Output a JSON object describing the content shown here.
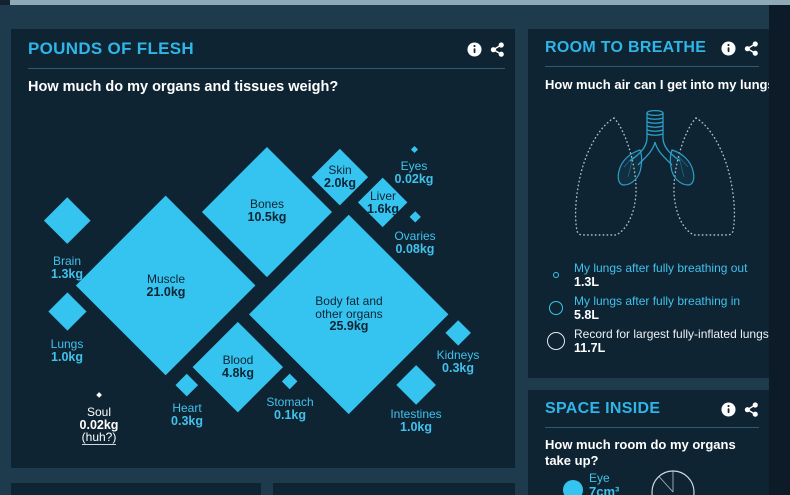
{
  "page": {
    "top_strip_color": "#90a9b9",
    "background_color": "#1d3b4c",
    "panel_color": "#0e2433",
    "accent_color": "#35c4f0"
  },
  "pounds_panel": {
    "title": "POUNDS OF FLESH",
    "question": "How much do my organs and tissues weigh?"
  },
  "breathe_panel": {
    "title": "ROOM TO BREATHE",
    "question": "How much air can I get into my lungs?",
    "legend": [
      {
        "label": "My lungs after fully breathing out",
        "value": "1.3L"
      },
      {
        "label": "My lungs after fully breathing in",
        "value": "5.8L"
      },
      {
        "label": "Record for largest fully-inflated lungs",
        "value": "11.7L"
      }
    ]
  },
  "space_panel": {
    "title": "SPACE INSIDE",
    "question": "How much room do my organs take up?",
    "items": [
      {
        "name": "Eye",
        "value": "7cm³"
      }
    ]
  },
  "chart_data": [
    {
      "type": "diamond-area",
      "title": "POUNDS OF FLESH",
      "question": "How much do my organs and tissues weigh?",
      "unit": "kg",
      "points": [
        {
          "name_lines": [
            "Muscle"
          ],
          "weight": "21.0kg",
          "value_kg": 21.0,
          "cx": 155,
          "cy": 257,
          "r": 90,
          "label": "inside",
          "label_top": 244
        },
        {
          "name_lines": [
            "Bones"
          ],
          "weight": "10.5kg",
          "value_kg": 10.5,
          "cx": 256,
          "cy": 183,
          "r": 65,
          "label": "inside",
          "label_top": 169
        },
        {
          "name_lines": [
            "Body fat and",
            "other organs"
          ],
          "weight": "25.9kg",
          "value_kg": 25.9,
          "cx": 338,
          "cy": 286,
          "r": 100,
          "label": "inside",
          "label_top": 266
        },
        {
          "name_lines": [
            "Blood"
          ],
          "weight": "4.8kg",
          "value_kg": 4.8,
          "cx": 227,
          "cy": 338,
          "r": 45,
          "label": "inside",
          "label_top": 325
        },
        {
          "name_lines": [
            "Skin"
          ],
          "weight": "2.0kg",
          "value_kg": 2.0,
          "cx": 329,
          "cy": 148,
          "r": 28,
          "label": "inside",
          "label_top": 135
        },
        {
          "name_lines": [
            "Liver"
          ],
          "weight": "1.6kg",
          "value_kg": 1.6,
          "cx": 372,
          "cy": 174,
          "r": 25,
          "label": "inside",
          "label_top": 161
        },
        {
          "name_lines": [
            "Brain"
          ],
          "weight": "1.3kg",
          "value_kg": 1.3,
          "cx": 56,
          "cy": 191,
          "r": 23,
          "label": "outside",
          "label_top": 226
        },
        {
          "name_lines": [
            "Lungs"
          ],
          "weight": "1.0kg",
          "value_kg": 1.0,
          "cx": 56,
          "cy": 282,
          "r": 19,
          "label": "outside",
          "label_top": 309
        },
        {
          "name_lines": [
            "Heart"
          ],
          "weight": "0.3kg",
          "value_kg": 0.3,
          "cx": 176,
          "cy": 356,
          "r": 11,
          "label": "outside",
          "label_top": 373
        },
        {
          "name_lines": [
            "Stomach"
          ],
          "weight": "0.1kg",
          "value_kg": 0.1,
          "cx": 279,
          "cy": 353,
          "r": 8,
          "label": "outside",
          "label_top": 367
        },
        {
          "name_lines": [
            "Intestines"
          ],
          "weight": "1.0kg",
          "value_kg": 1.0,
          "cx": 405,
          "cy": 356,
          "r": 20,
          "label": "outside",
          "label_top": 379
        },
        {
          "name_lines": [
            "Kidneys"
          ],
          "weight": "0.3kg",
          "value_kg": 0.3,
          "cx": 447,
          "cy": 304,
          "r": 13,
          "label": "outside",
          "label_top": 320
        },
        {
          "name_lines": [
            "Ovaries"
          ],
          "weight": "0.08kg",
          "value_kg": 0.08,
          "cx": 404,
          "cy": 188,
          "r": 6,
          "label": "outside",
          "label_top": 201
        },
        {
          "name_lines": [
            "Eyes"
          ],
          "weight": "0.02kg",
          "value_kg": 0.02,
          "cx": 403,
          "cy": 120,
          "r": 3.5,
          "label": "outside",
          "label_top": 131
        },
        {
          "name_lines": [
            "Soul"
          ],
          "weight": "0.02kg",
          "value_kg": 0.02,
          "cx": 88,
          "cy": 366,
          "r": 3,
          "label": "soul",
          "label_top": 377,
          "link": "(huh?)"
        }
      ]
    },
    {
      "type": "lung-volumes",
      "title": "ROOM TO BREATHE",
      "question": "How much air can I get into my lungs?",
      "unit": "L",
      "items": [
        {
          "label": "My lungs after fully breathing out",
          "value_l": 1.3,
          "display": "1.3L"
        },
        {
          "label": "My lungs after fully breathing in",
          "value_l": 5.8,
          "display": "5.8L"
        },
        {
          "label": "Record for largest fully-inflated lungs",
          "value_l": 11.7,
          "display": "11.7L"
        }
      ]
    },
    {
      "type": "organ-volumes",
      "title": "SPACE INSIDE",
      "question": "How much room do my organs take up?",
      "unit": "cm³",
      "items": [
        {
          "name": "Eye",
          "value_cm3": 7,
          "display": "7cm³"
        }
      ]
    }
  ]
}
